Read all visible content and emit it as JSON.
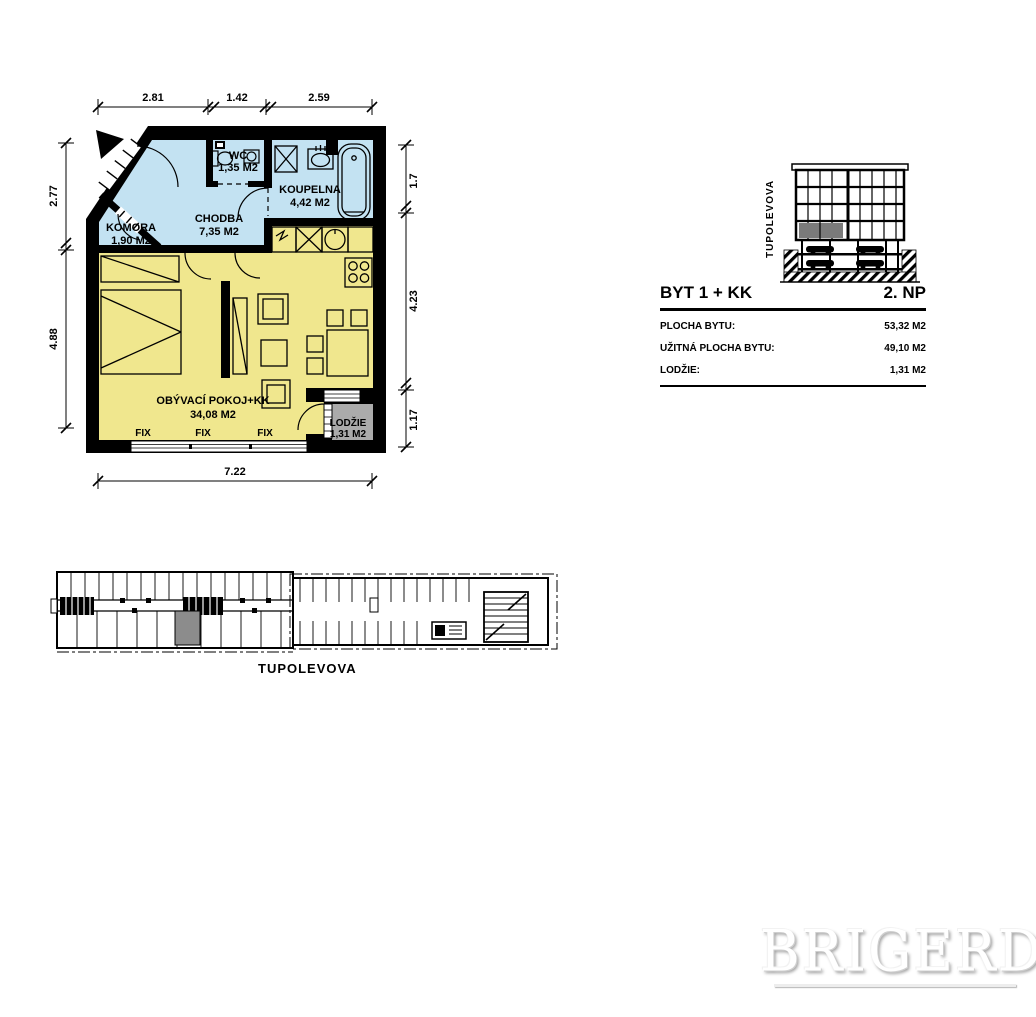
{
  "plan": {
    "rooms": [
      {
        "name": "KOMORA",
        "area": "1,90 M2"
      },
      {
        "name": "CHODBA",
        "area": "7,35 M2"
      },
      {
        "name": "WC",
        "area": "1,35 M2"
      },
      {
        "name": "KOUPELNA",
        "area": "4,42 M2"
      },
      {
        "name": "OBÝVACÍ POKOJ+KK",
        "area": "34,08 M2"
      },
      {
        "name": "LODŽIE",
        "area": "1,31 M2"
      }
    ],
    "window_labels": [
      "FIX",
      "FIX",
      "FIX"
    ],
    "loggia_symbol": "2L",
    "dimensions": {
      "top": [
        "2.81",
        "1.42",
        "2.59"
      ],
      "left": [
        "2.77",
        "4.88"
      ],
      "right": [
        "1.7",
        "4.23",
        "1.17"
      ],
      "bottom": [
        "7.22"
      ]
    },
    "colors": {
      "living_zone": "#f0e78e",
      "entry_zone": "#c3e2f2",
      "loggia": "#ababab",
      "wall": "#000000",
      "highlight_gray": "#8c8c8c"
    }
  },
  "info_table": {
    "unit": "BYT 1 + KK",
    "floor": "2. NP",
    "rows": [
      {
        "label": "PLOCHA BYTU:",
        "value": "53,32 M2"
      },
      {
        "label": "UŽITNÁ PLOCHA BYTU:",
        "value": "49,10 M2"
      },
      {
        "label": "LODŽIE:",
        "value": "1,31 M2"
      }
    ]
  },
  "section": {
    "street": "TUPOLEVOVA"
  },
  "site_plan": {
    "street": "TUPOLEVOVA"
  },
  "watermark": {
    "text": "BRIGERD"
  }
}
